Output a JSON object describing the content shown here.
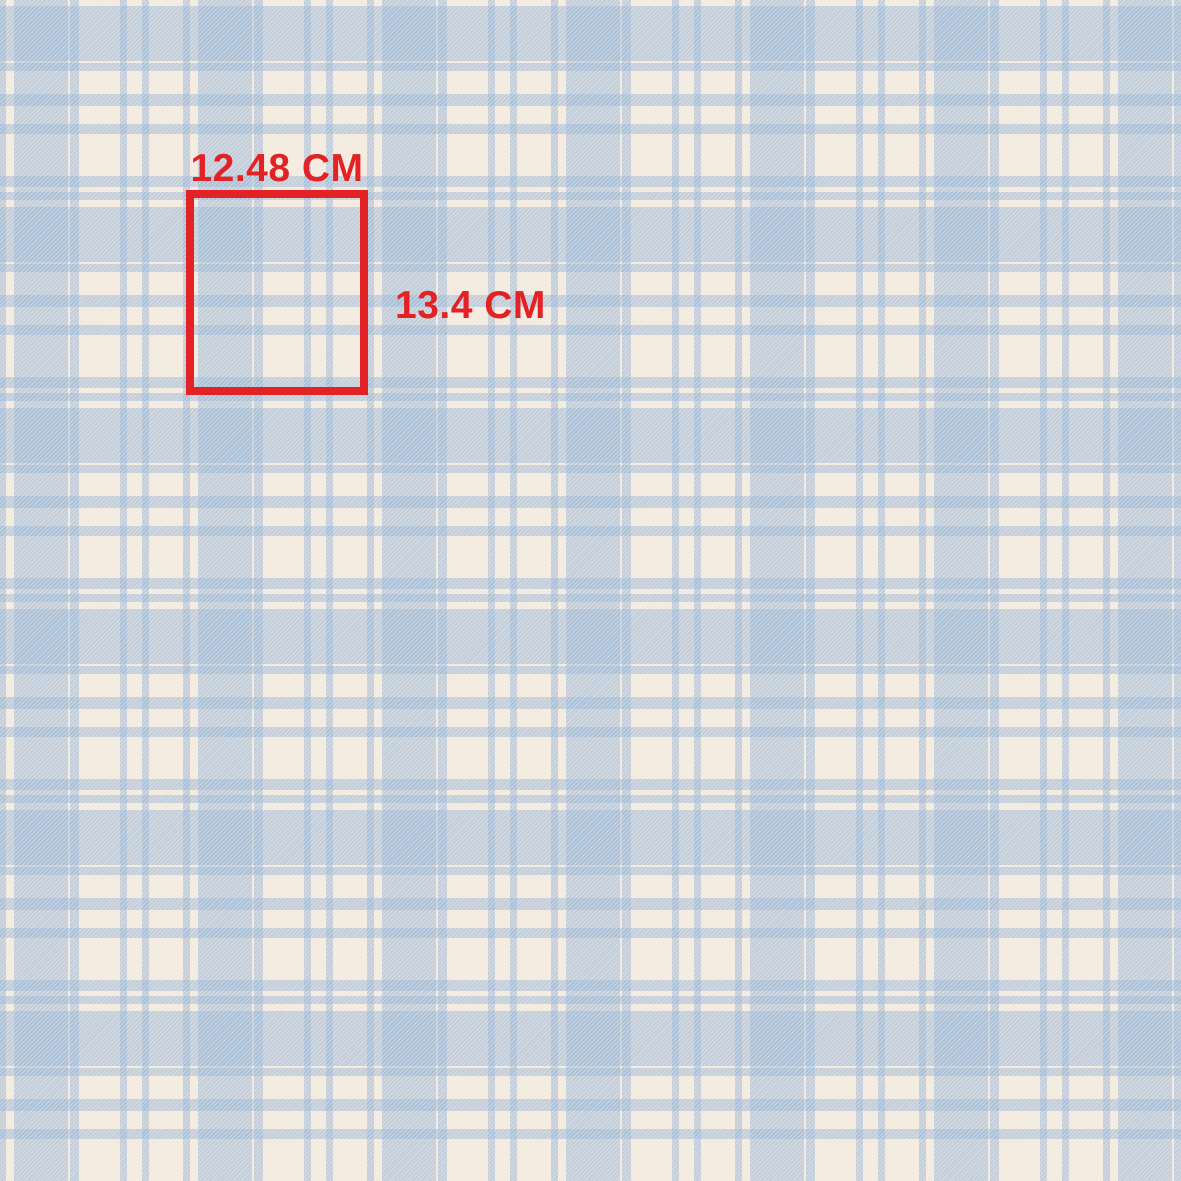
{
  "swatch": {
    "description": "Seamless plaid tartan fabric pattern, light blue on cream with diagonal twill weave texture",
    "pattern_type": "plaid-tartan-twill",
    "annotation": {
      "width_label": "12.48 CM",
      "height_label": "13.4 CM",
      "width_cm": 12.48,
      "height_cm": 13.4
    },
    "repeat": {
      "horizontal_px": 184,
      "vertical_px": 201
    }
  },
  "theme": {
    "cream": "#f3ebdf",
    "plaid_blue": "#96b4d7",
    "solid_square_blue": "#a9c1da",
    "hatched_band_blue": "#c5d1e0",
    "annotation_red": "#e32226"
  }
}
